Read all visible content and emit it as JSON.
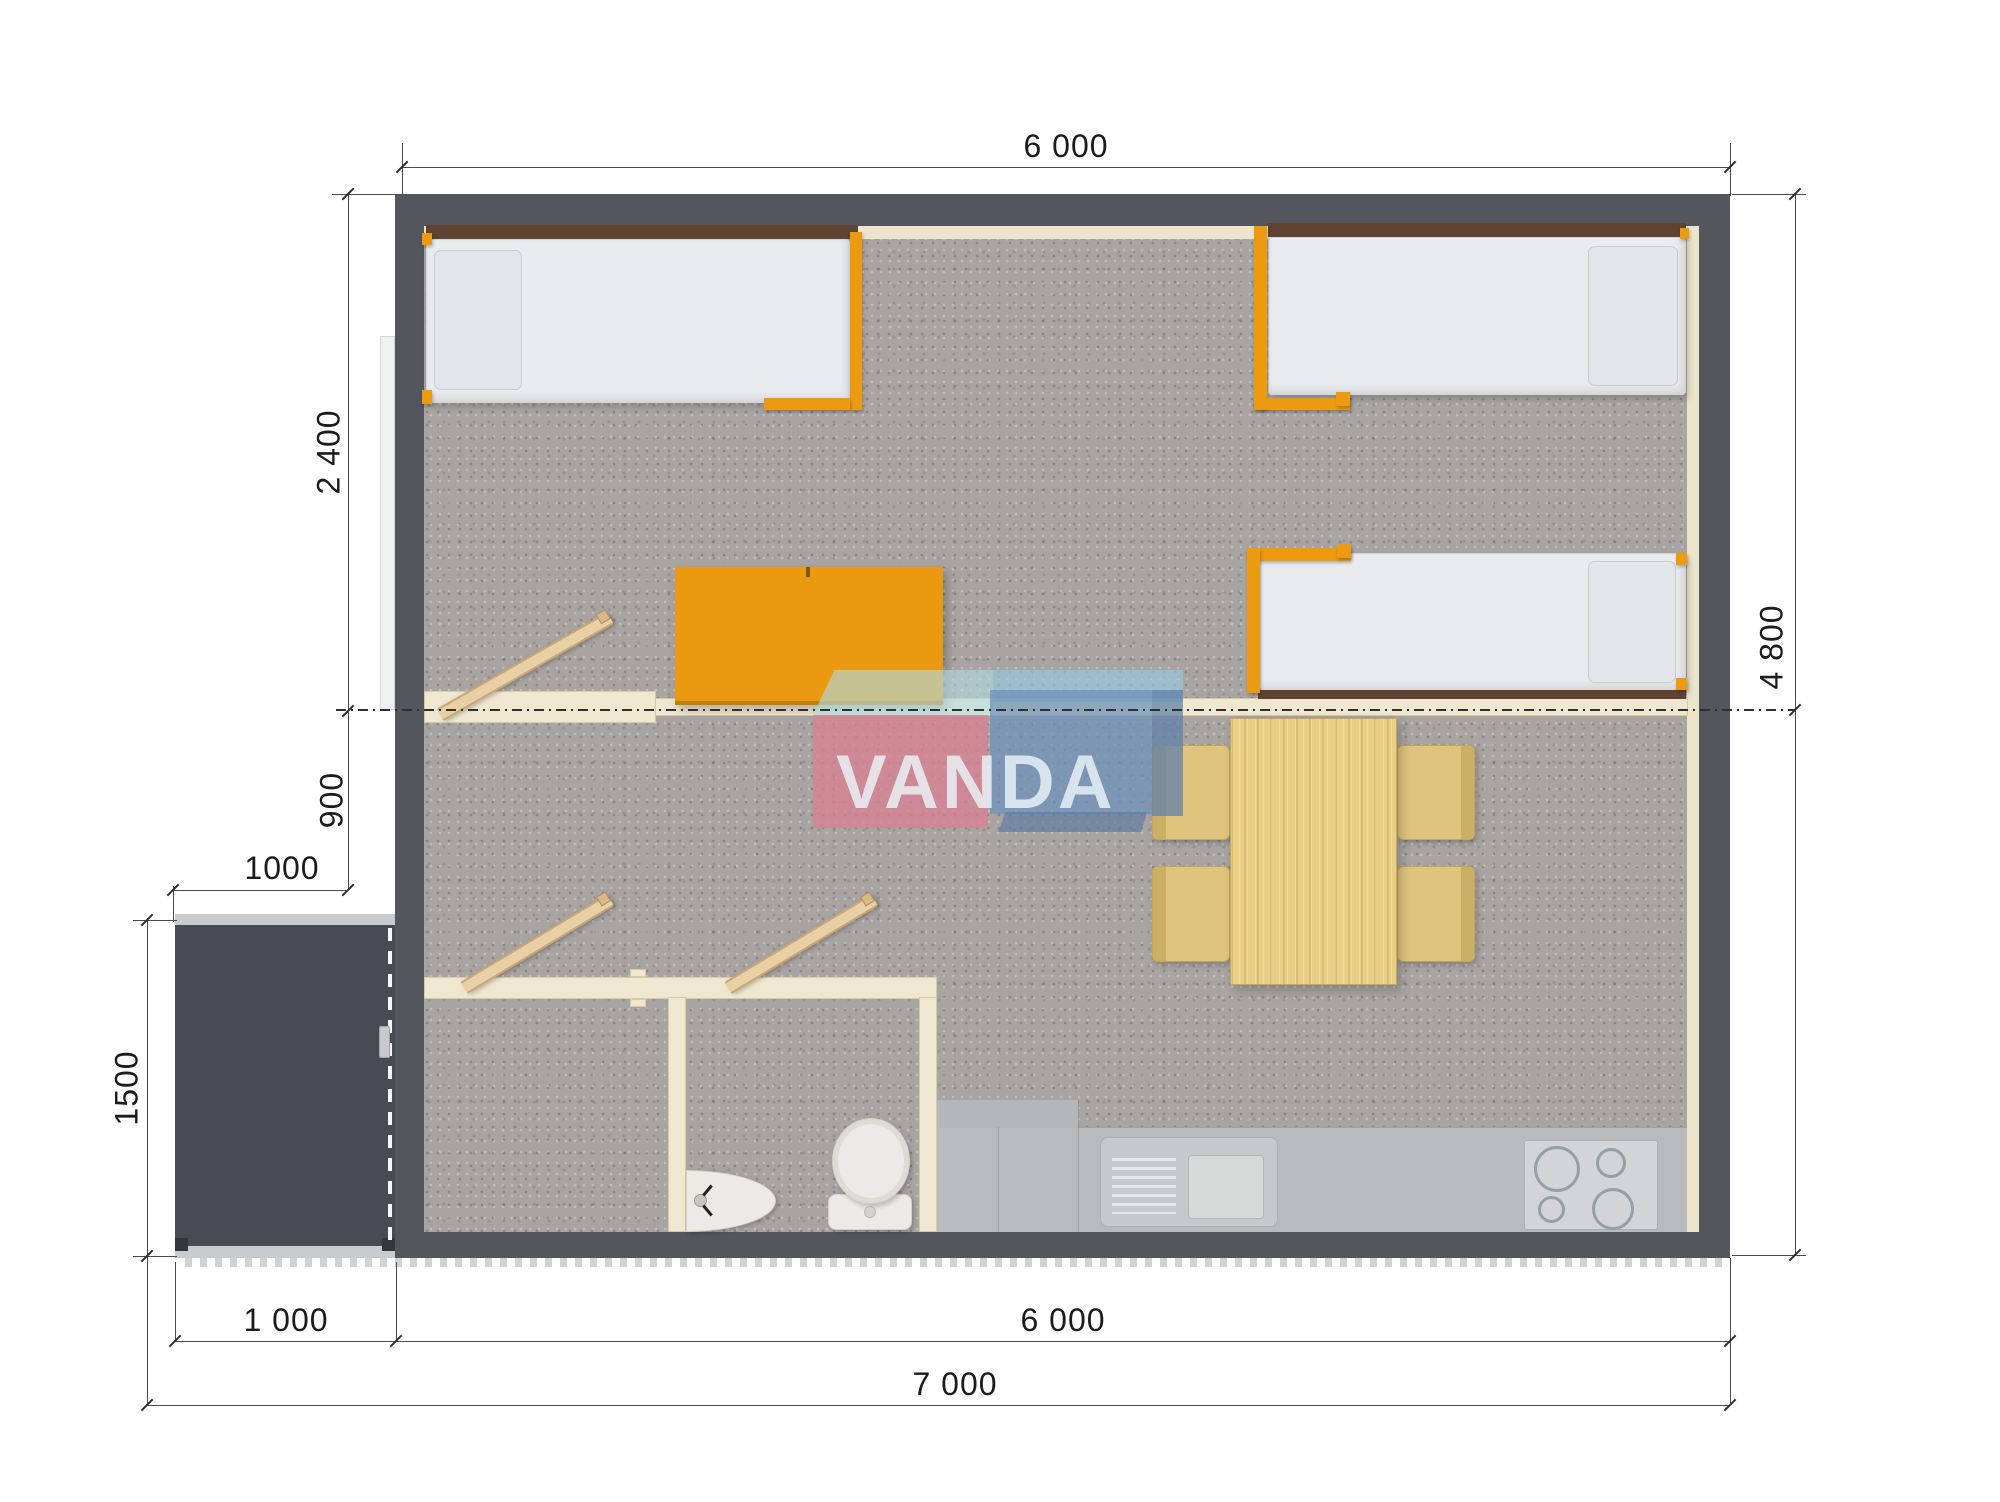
{
  "watermark": {
    "text": "VANDA"
  },
  "dimensions": {
    "top_width": "6 000",
    "bedroom_depth": "2 400",
    "hall_depth": "900",
    "porch_width_top": "1000",
    "porch_depth": "1500",
    "porch_width_bottom": "1 000",
    "house_width_bottom": "6 000",
    "total_width": "7 000",
    "house_depth": "4 800"
  },
  "colors": {
    "exterior_wall": "#53565d",
    "porch_deck": "#474b53",
    "carpet_floor": "#a8a4a2",
    "interior_wall": "#efe7cf",
    "furniture_orange": "#ec9a10",
    "wood": "#e9cf86",
    "kitchen_floor": "#b8bbbe",
    "logo_pink": "#d68292",
    "logo_blue": "#6e91b9",
    "logo_teal": "#b0dbe2",
    "dimension_line": "#4a4a4a"
  },
  "furniture": [
    "single-bed",
    "single-bed",
    "single-bed",
    "desk",
    "dining-table",
    "chair",
    "chair",
    "chair",
    "chair",
    "ladder",
    "ladder",
    "ladder",
    "toilet",
    "wash-basin",
    "kitchen-sink-unit",
    "stove",
    "sliding-door",
    "porch-deck"
  ]
}
